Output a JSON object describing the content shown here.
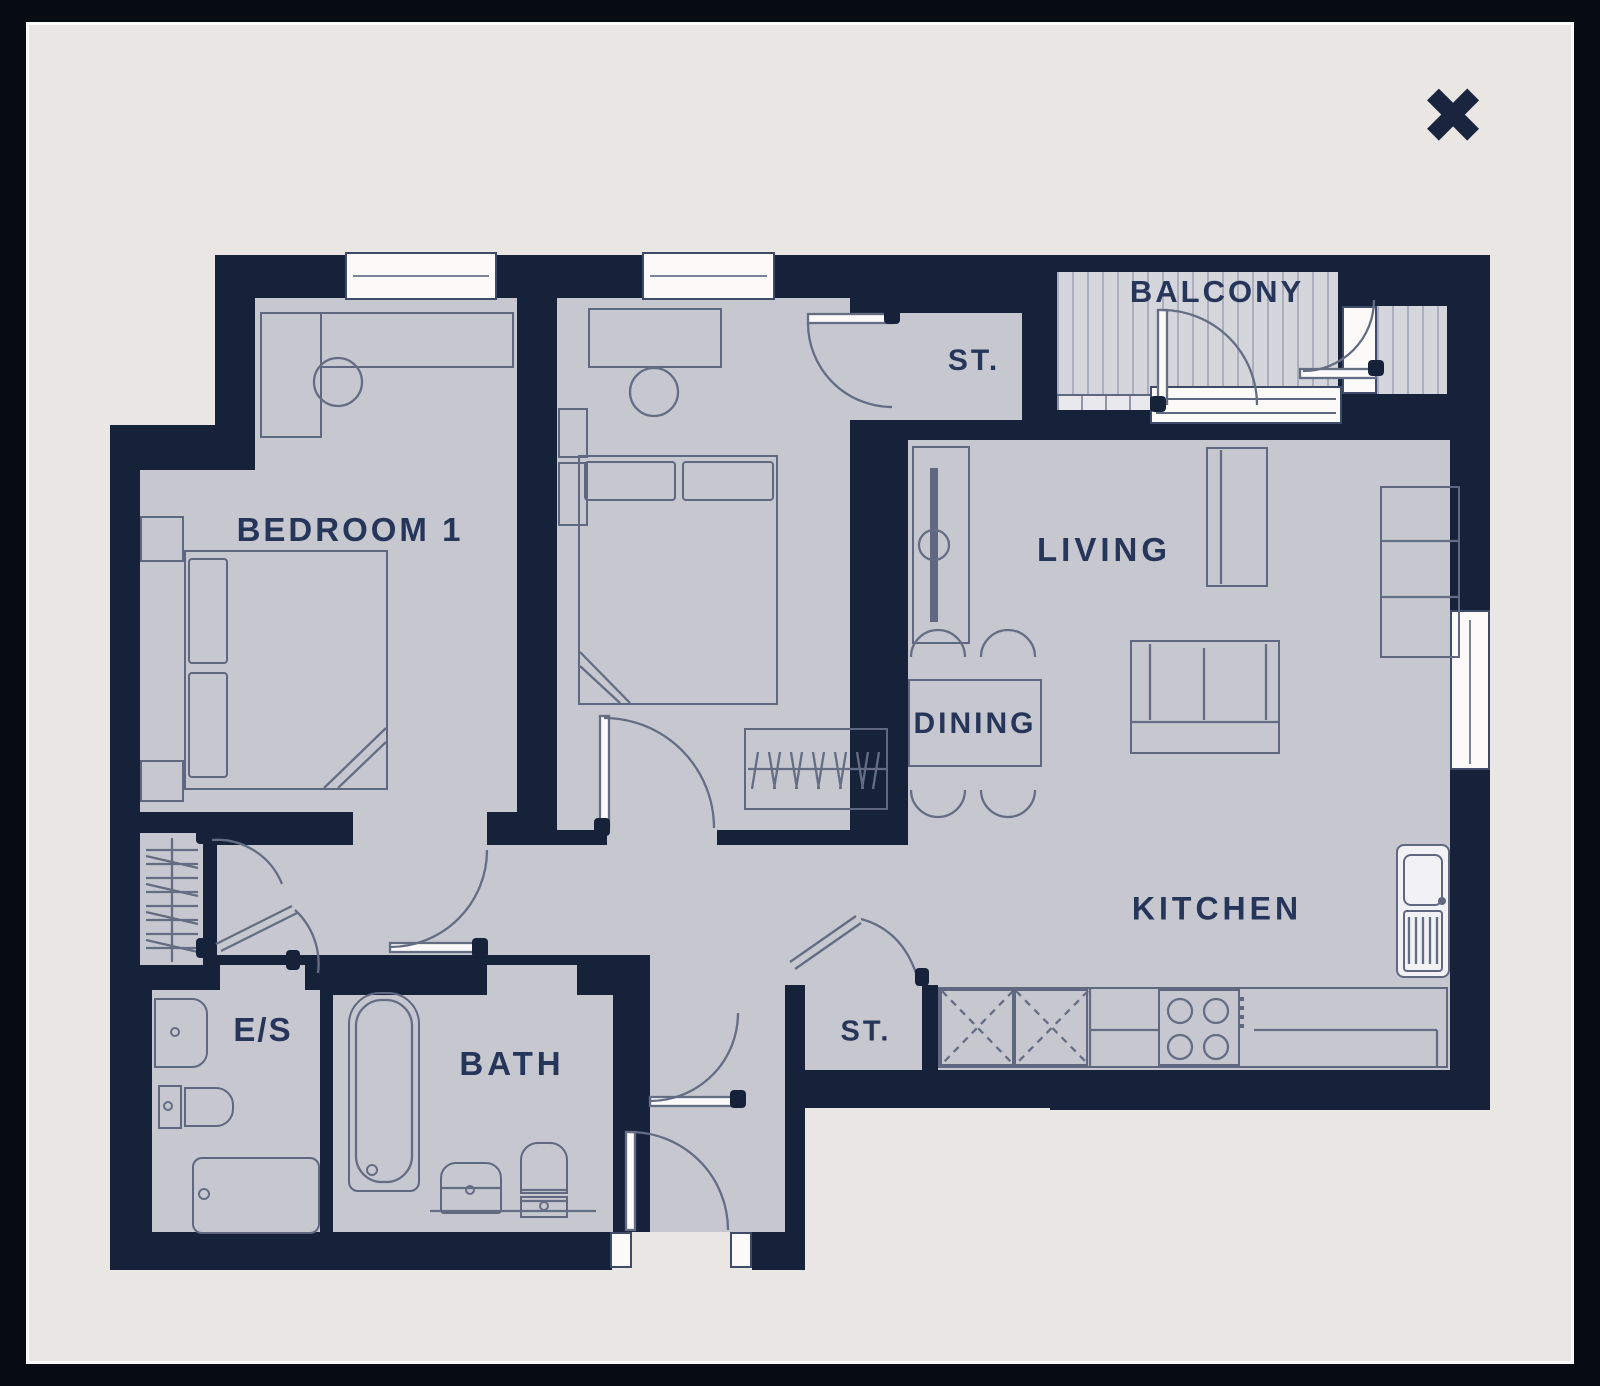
{
  "modal": {
    "close_glyph": "✖"
  },
  "labels": {
    "bedroom1": "BEDROOM 1",
    "storage_top": "ST.",
    "balcony": "BALCONY",
    "living": "LIVING",
    "dining": "DINING",
    "kitchen": "KITCHEN",
    "ensuite": "E/S",
    "bath": "BATH",
    "storage_hall": "ST."
  },
  "colors": {
    "outer_background": "#070b13",
    "panel_background": "#eae6e4",
    "wall": "#16213a",
    "floor": "#c7c8cf",
    "furniture_line": "#5f6880",
    "label_text": "#26355a",
    "white_fitting": "#fbfaf9"
  }
}
